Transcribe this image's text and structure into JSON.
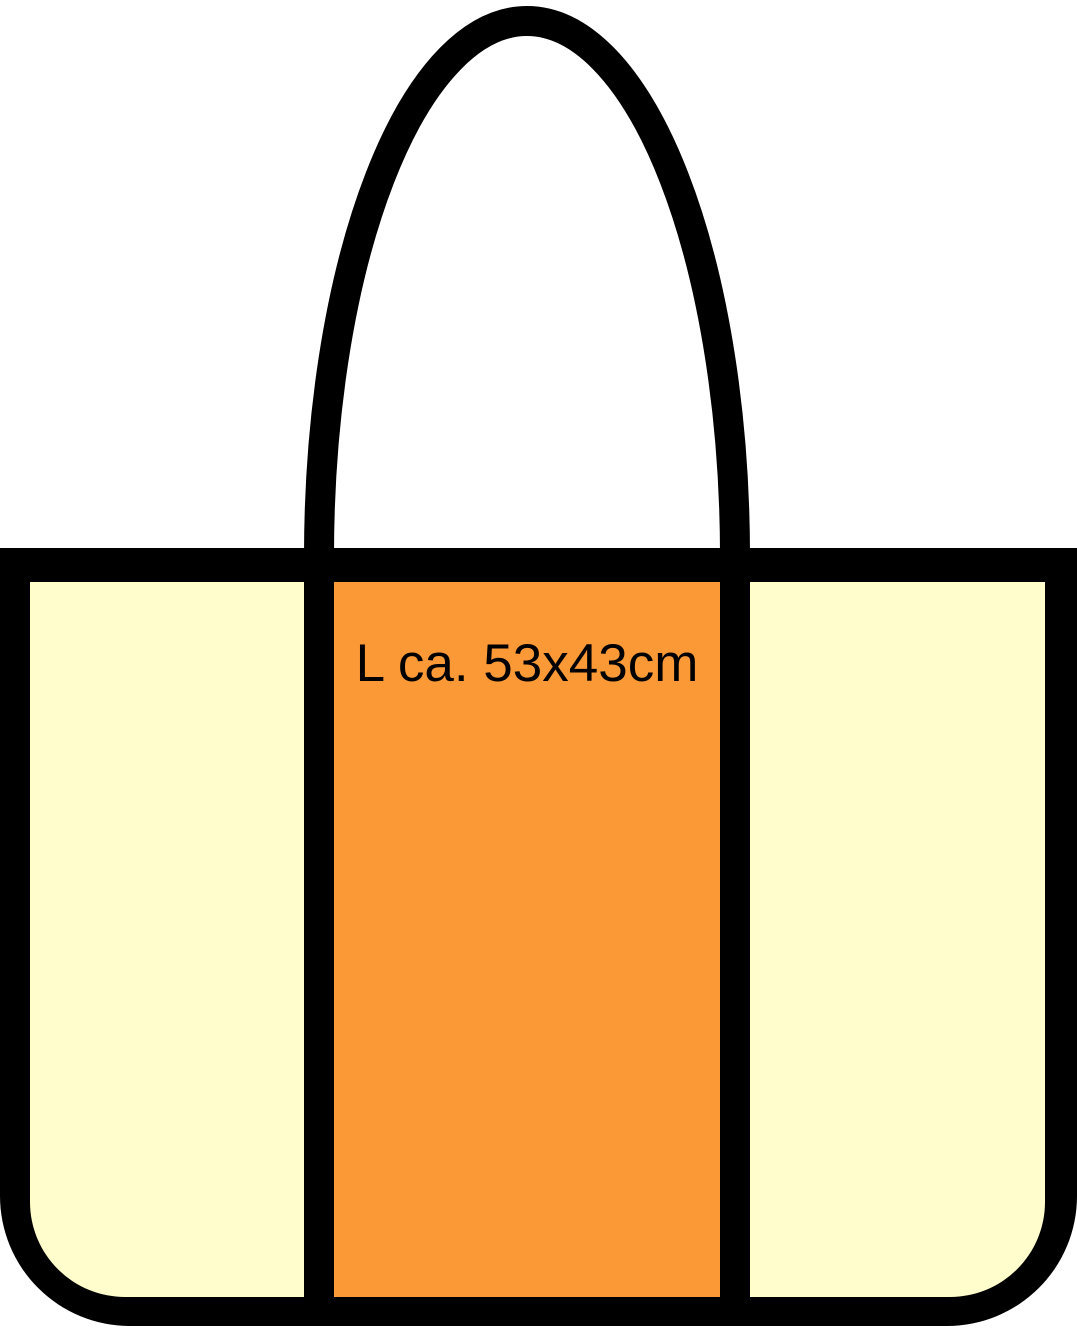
{
  "illustration": {
    "title": "tote-bag-size-diagram",
    "size_label": "L ca. 53x43cm"
  },
  "colors": {
    "background": "#FFFFFF",
    "outline": "#000000",
    "side_panel": "#FFFDCB",
    "center_panel": "#FC9937",
    "label_text": "#000000"
  }
}
